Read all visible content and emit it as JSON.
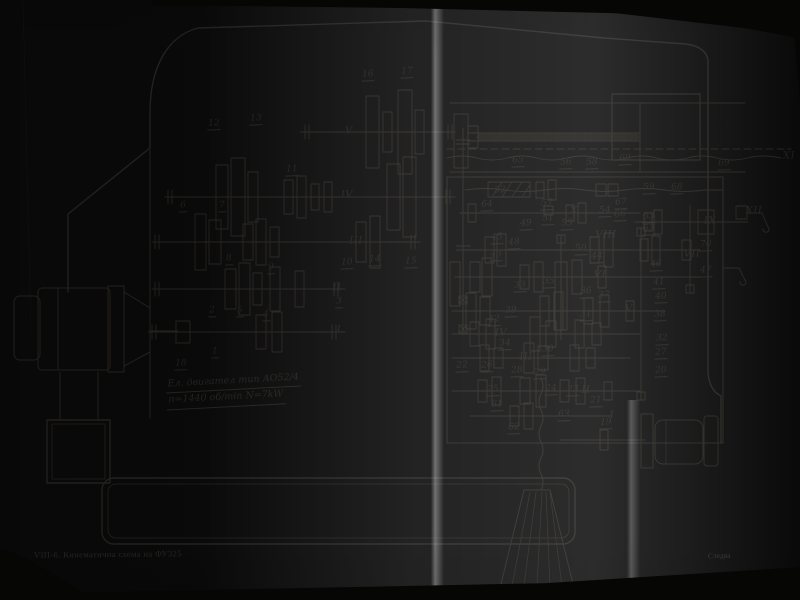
{
  "page": {
    "header_top": "с к о р о с т и т е",
    "caption": "VIII-6. Кинематична схема на ФУ325",
    "caption_right": "Следва",
    "motor_spec_line1": "Ел. двигател тип АО52/4",
    "motor_spec_line2": "n=1440 об/min  N=7kW"
  },
  "colors": {
    "paper": "#d4d2cc",
    "ink": "#26241f",
    "photo_edge": "#060605"
  },
  "diagram": {
    "shaft_labels": [
      {
        "t": "I",
        "x": 339,
        "y": 331
      },
      {
        "t": "II",
        "x": 337,
        "y": 289
      },
      {
        "t": "III",
        "x": 356,
        "y": 242
      },
      {
        "t": "IV",
        "x": 347,
        "y": 196
      },
      {
        "t": "V",
        "x": 349,
        "y": 132
      },
      {
        "t": "I",
        "x": 612,
        "y": 416
      },
      {
        "t": "II",
        "x": 586,
        "y": 391
      },
      {
        "t": "III",
        "x": 526,
        "y": 358
      },
      {
        "t": "IV",
        "x": 501,
        "y": 334
      },
      {
        "t": "V",
        "x": 629,
        "y": 310
      },
      {
        "t": "VI",
        "x": 600,
        "y": 276
      },
      {
        "t": "VII",
        "x": 692,
        "y": 255
      },
      {
        "t": "VIII",
        "x": 606,
        "y": 236
      },
      {
        "t": "IX",
        "x": 710,
        "y": 222
      },
      {
        "t": "X",
        "x": 574,
        "y": 212
      },
      {
        "t": "XI",
        "x": 789,
        "y": 157
      },
      {
        "t": "XII",
        "x": 754,
        "y": 212
      }
    ],
    "part_labels": [
      {
        "t": "1",
        "x": 215,
        "y": 354
      },
      {
        "t": "2",
        "x": 212,
        "y": 313
      },
      {
        "t": "3",
        "x": 339,
        "y": 304
      },
      {
        "t": "4",
        "x": 266,
        "y": 317
      },
      {
        "t": "5",
        "x": 240,
        "y": 313
      },
      {
        "t": "6",
        "x": 183,
        "y": 208
      },
      {
        "t": "7",
        "x": 222,
        "y": 208
      },
      {
        "t": "8",
        "x": 229,
        "y": 261
      },
      {
        "t": "9",
        "x": 271,
        "y": 270
      },
      {
        "t": "10",
        "x": 347,
        "y": 265
      },
      {
        "t": "11",
        "x": 292,
        "y": 172
      },
      {
        "t": "12",
        "x": 214,
        "y": 126
      },
      {
        "t": "13",
        "x": 256,
        "y": 121
      },
      {
        "t": "14",
        "x": 375,
        "y": 262
      },
      {
        "t": "15",
        "x": 411,
        "y": 264
      },
      {
        "t": "16",
        "x": 368,
        "y": 77
      },
      {
        "t": "17",
        "x": 407,
        "y": 74
      },
      {
        "t": "18",
        "x": 181,
        "y": 366
      },
      {
        "t": "19",
        "x": 606,
        "y": 425
      },
      {
        "t": "20",
        "x": 661,
        "y": 373
      },
      {
        "t": "21",
        "x": 596,
        "y": 403
      },
      {
        "t": "22",
        "x": 462,
        "y": 368
      },
      {
        "t": "23",
        "x": 573,
        "y": 392
      },
      {
        "t": "24",
        "x": 551,
        "y": 391
      },
      {
        "t": "25",
        "x": 493,
        "y": 392
      },
      {
        "t": "26",
        "x": 487,
        "y": 368
      },
      {
        "t": "27",
        "x": 661,
        "y": 355
      },
      {
        "t": "28",
        "x": 517,
        "y": 373
      },
      {
        "t": "29",
        "x": 540,
        "y": 375
      },
      {
        "t": "30",
        "x": 548,
        "y": 352
      },
      {
        "t": "31",
        "x": 586,
        "y": 317
      },
      {
        "t": "32",
        "x": 662,
        "y": 341
      },
      {
        "t": "33",
        "x": 520,
        "y": 288
      },
      {
        "t": "34",
        "x": 505,
        "y": 346
      },
      {
        "t": "35",
        "x": 549,
        "y": 284
      },
      {
        "t": "36",
        "x": 586,
        "y": 294
      },
      {
        "t": "37",
        "x": 604,
        "y": 298
      },
      {
        "t": "38",
        "x": 660,
        "y": 317
      },
      {
        "t": "39",
        "x": 511,
        "y": 313
      },
      {
        "t": "40",
        "x": 661,
        "y": 299
      },
      {
        "t": "41",
        "x": 659,
        "y": 285
      },
      {
        "t": "42",
        "x": 494,
        "y": 322
      },
      {
        "t": "43",
        "x": 496,
        "y": 257
      },
      {
        "t": "44",
        "x": 597,
        "y": 259
      },
      {
        "t": "45",
        "x": 497,
        "y": 240
      },
      {
        "t": "46",
        "x": 656,
        "y": 267
      },
      {
        "t": "47",
        "x": 706,
        "y": 273
      },
      {
        "t": "48",
        "x": 514,
        "y": 245
      },
      {
        "t": "49",
        "x": 526,
        "y": 226
      },
      {
        "t": "50",
        "x": 581,
        "y": 251
      },
      {
        "t": "51",
        "x": 548,
        "y": 221
      },
      {
        "t": "52",
        "x": 500,
        "y": 193
      },
      {
        "t": "53",
        "x": 649,
        "y": 231
      },
      {
        "t": "54",
        "x": 605,
        "y": 213
      },
      {
        "t": "55",
        "x": 567,
        "y": 226
      },
      {
        "t": "56",
        "x": 566,
        "y": 165
      },
      {
        "t": "57",
        "x": 547,
        "y": 206
      },
      {
        "t": "58",
        "x": 592,
        "y": 165
      },
      {
        "t": "59",
        "x": 649,
        "y": 190
      },
      {
        "t": "60",
        "x": 625,
        "y": 161
      },
      {
        "t": "61",
        "x": 497,
        "y": 407
      },
      {
        "t": "62",
        "x": 514,
        "y": 430
      },
      {
        "t": "63",
        "x": 649,
        "y": 219
      },
      {
        "t": "63",
        "x": 564,
        "y": 417
      },
      {
        "t": "64",
        "x": 487,
        "y": 207
      },
      {
        "t": "65",
        "x": 518,
        "y": 163
      },
      {
        "t": "66",
        "x": 620,
        "y": 217
      },
      {
        "t": "67",
        "x": 621,
        "y": 205
      },
      {
        "t": "68",
        "x": 677,
        "y": 190
      },
      {
        "t": "69",
        "x": 724,
        "y": 166
      },
      {
        "t": "70",
        "x": 706,
        "y": 247
      }
    ]
  }
}
